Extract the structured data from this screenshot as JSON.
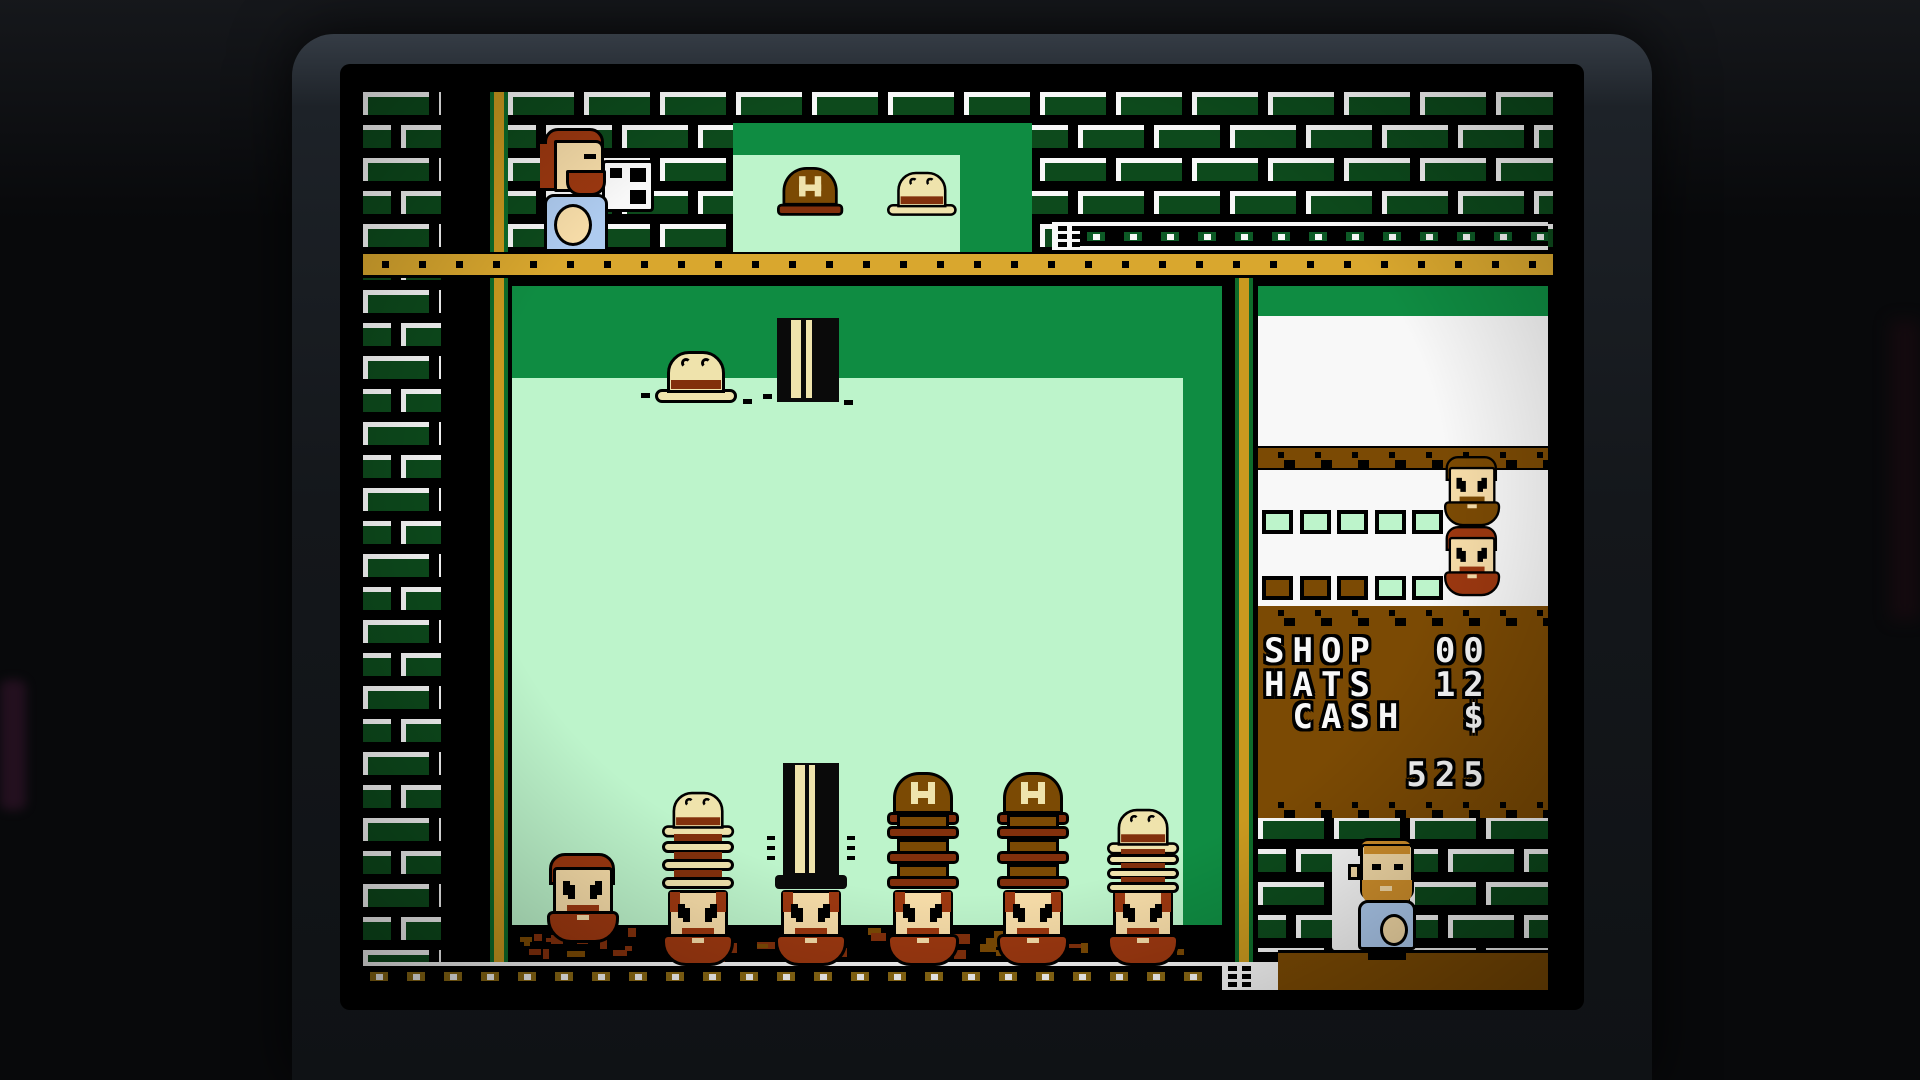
{
  "hud": {
    "shop_label": "SHOP",
    "shop_value": "00",
    "hats_label": "HATS",
    "hats_value": "12",
    "cash_label": "CASH",
    "cash_symbol": "$",
    "cash_value": "525",
    "lines": [
      "SHOP  00",
      "HATS  12",
      " CASH  $",
      "     525"
    ]
  },
  "order_progress": {
    "row1": [
      "green",
      "green",
      "green",
      "green",
      "green"
    ],
    "row2": [
      "brown",
      "brown",
      "brown",
      "green",
      "green"
    ]
  },
  "dispenser_hats": [
    "hardhat",
    "bowler"
  ],
  "falling_hats": [
    "bowler",
    "tophat"
  ],
  "head_stacks": [
    {
      "hat": null,
      "count": 0
    },
    {
      "hat": "bowler",
      "count": 4
    },
    {
      "hat": "tophat",
      "count": 2
    },
    {
      "hat": "hardhat",
      "count": 4
    },
    {
      "hat": "hardhat",
      "count": 4
    },
    {
      "hat": "bowler",
      "count": 4
    }
  ],
  "sprites": [
    "hat-thrower",
    "shop-keeper",
    "order-face-1",
    "order-face-2"
  ],
  "colors": {
    "pale_green": "#BDF4CB",
    "mid_green": "#0F8C42",
    "brick_green": "#0D4A1C",
    "stripe_green": "#0E6B2A",
    "shelf_gold": "#D9A72E",
    "stripe_gold": "#C9991F",
    "panel_brown": "#7B4A04",
    "hat_rust": "#82300C",
    "cream": "#EFE3AC",
    "skin": "#F6DCA8",
    "shirt_blue": "#AECBEF",
    "hair_red": "#9C3810",
    "hair_orange": "#D2912C",
    "link_green": "#0D5A26",
    "link_brown": "#8B6914",
    "white": "#F8F8F8",
    "black": "#000000"
  }
}
